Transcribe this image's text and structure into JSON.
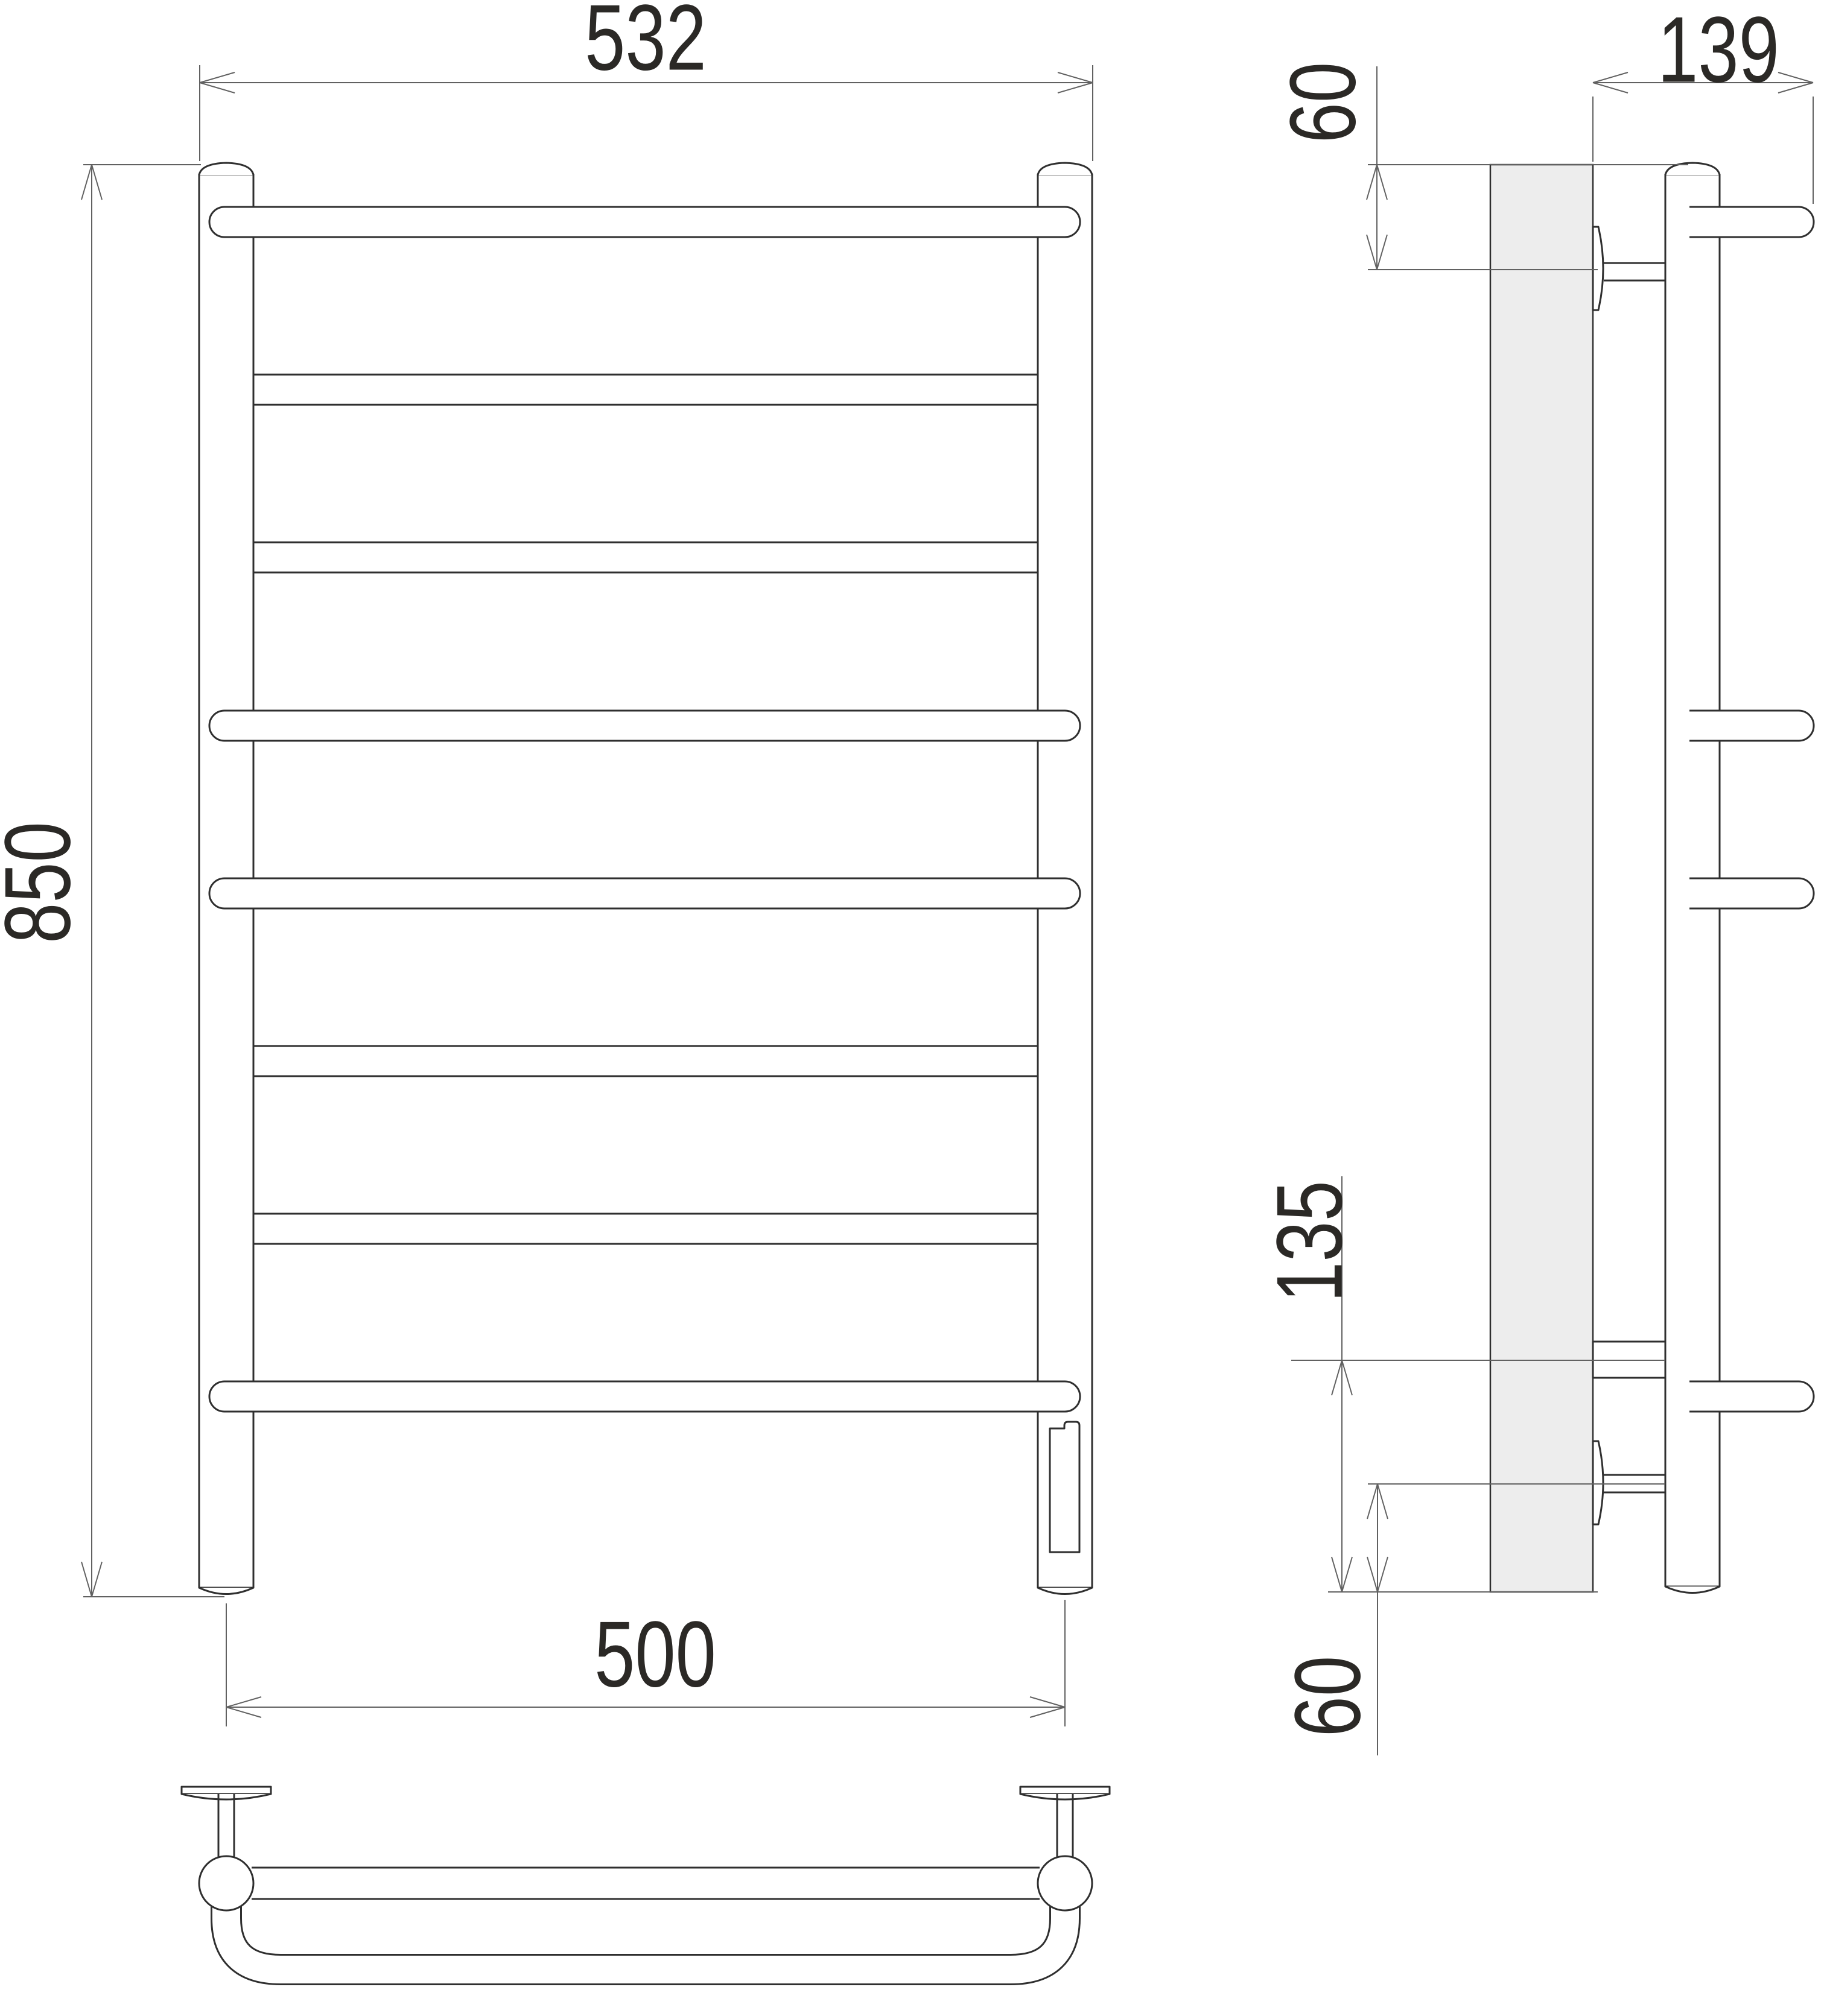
{
  "drawing": {
    "type": "technical-dimension-drawing",
    "subject": "ladder towel rail (8 crossbars) with electric heating element",
    "views": {
      "front": "front view with two vertical posts and 8 horizontal bars (4 protruding bowed bars, 4 straight bars)",
      "side": "side view with wall panel, two mounting brackets, post and 4 protruding bar ends",
      "top": "top view with U-shaped bowed bar, straight bar and two wall flanges"
    },
    "dims": {
      "top_width": "532",
      "height": "850",
      "bottom_width": "500",
      "depth": "139",
      "top_offset": "60",
      "connection_span": "135",
      "bottom_offset": "60"
    }
  },
  "colors": {
    "line": "#2f2f2f",
    "dim_line": "#616161",
    "text": "#2b2926",
    "wall_fill": "#ededed",
    "background": "#ffffff"
  }
}
